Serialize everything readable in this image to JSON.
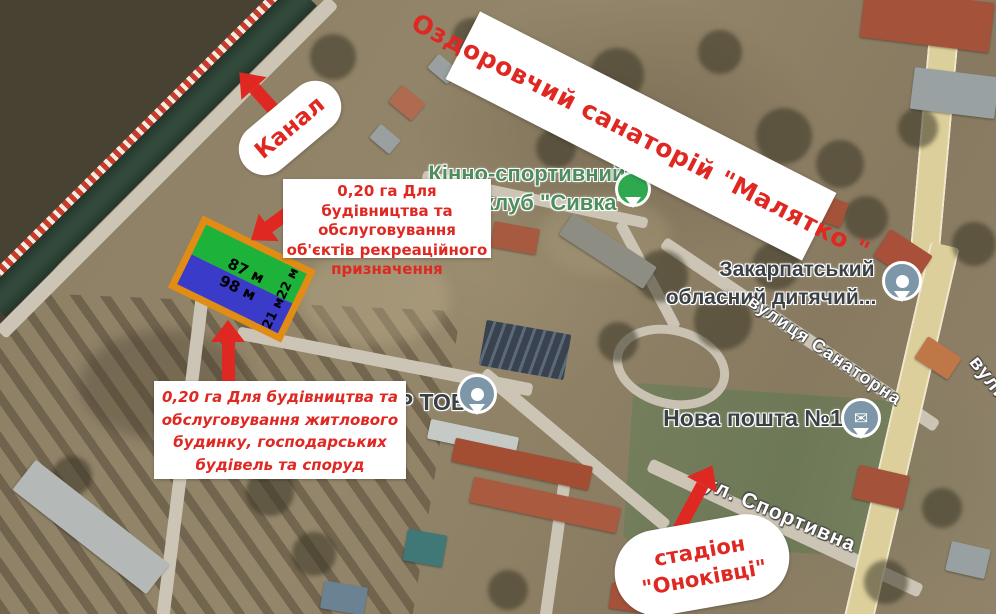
{
  "annotations": {
    "canal_label": "Канал",
    "banner": "Оздоровчий санаторій \"Малятко \"",
    "recreation_note": "0,20 га Для будівництва та обслуговування об'єктів рекреаційного призначення",
    "residential_note": "0,20 га Для будівництва та обслуговування житлового будинку, господарських будівель та споруд",
    "stadium_label_line1": "стадіон",
    "stadium_label_line2": "\"Оноківці\""
  },
  "parcel": {
    "top_width": "87 м",
    "top_side": "22 м",
    "bottom_width": "98 м",
    "bottom_side": "21 м"
  },
  "poi": {
    "kinno_line1": "Кінно-спортивний",
    "kinno_line2": "клуб \"Сивка\"",
    "zakarpatskyi_line1": "Закарпатський",
    "zakarpatskyi_line2": "обласний дитячий...",
    "nova_poshta": "Нова пошта №1",
    "er_tov": "ЕР ТОВ"
  },
  "streets": {
    "sanatorna": "вулиця Санаторна",
    "sportyvna": "ул. Спортивна",
    "partial_right": "вулиця"
  },
  "icons": {
    "mail": "✉"
  },
  "colors": {
    "accent-red": "#df2822",
    "parcel-green": "#1db33a",
    "parcel-blue": "#3a3bc8",
    "parcel-orange": "#e08c15",
    "poi-green": "#4e8d5e",
    "label-gray": "#3b4045",
    "pin-slate": "#7d96a8",
    "road-yellow": "#dccf9b",
    "canal-green": "#31493a"
  }
}
